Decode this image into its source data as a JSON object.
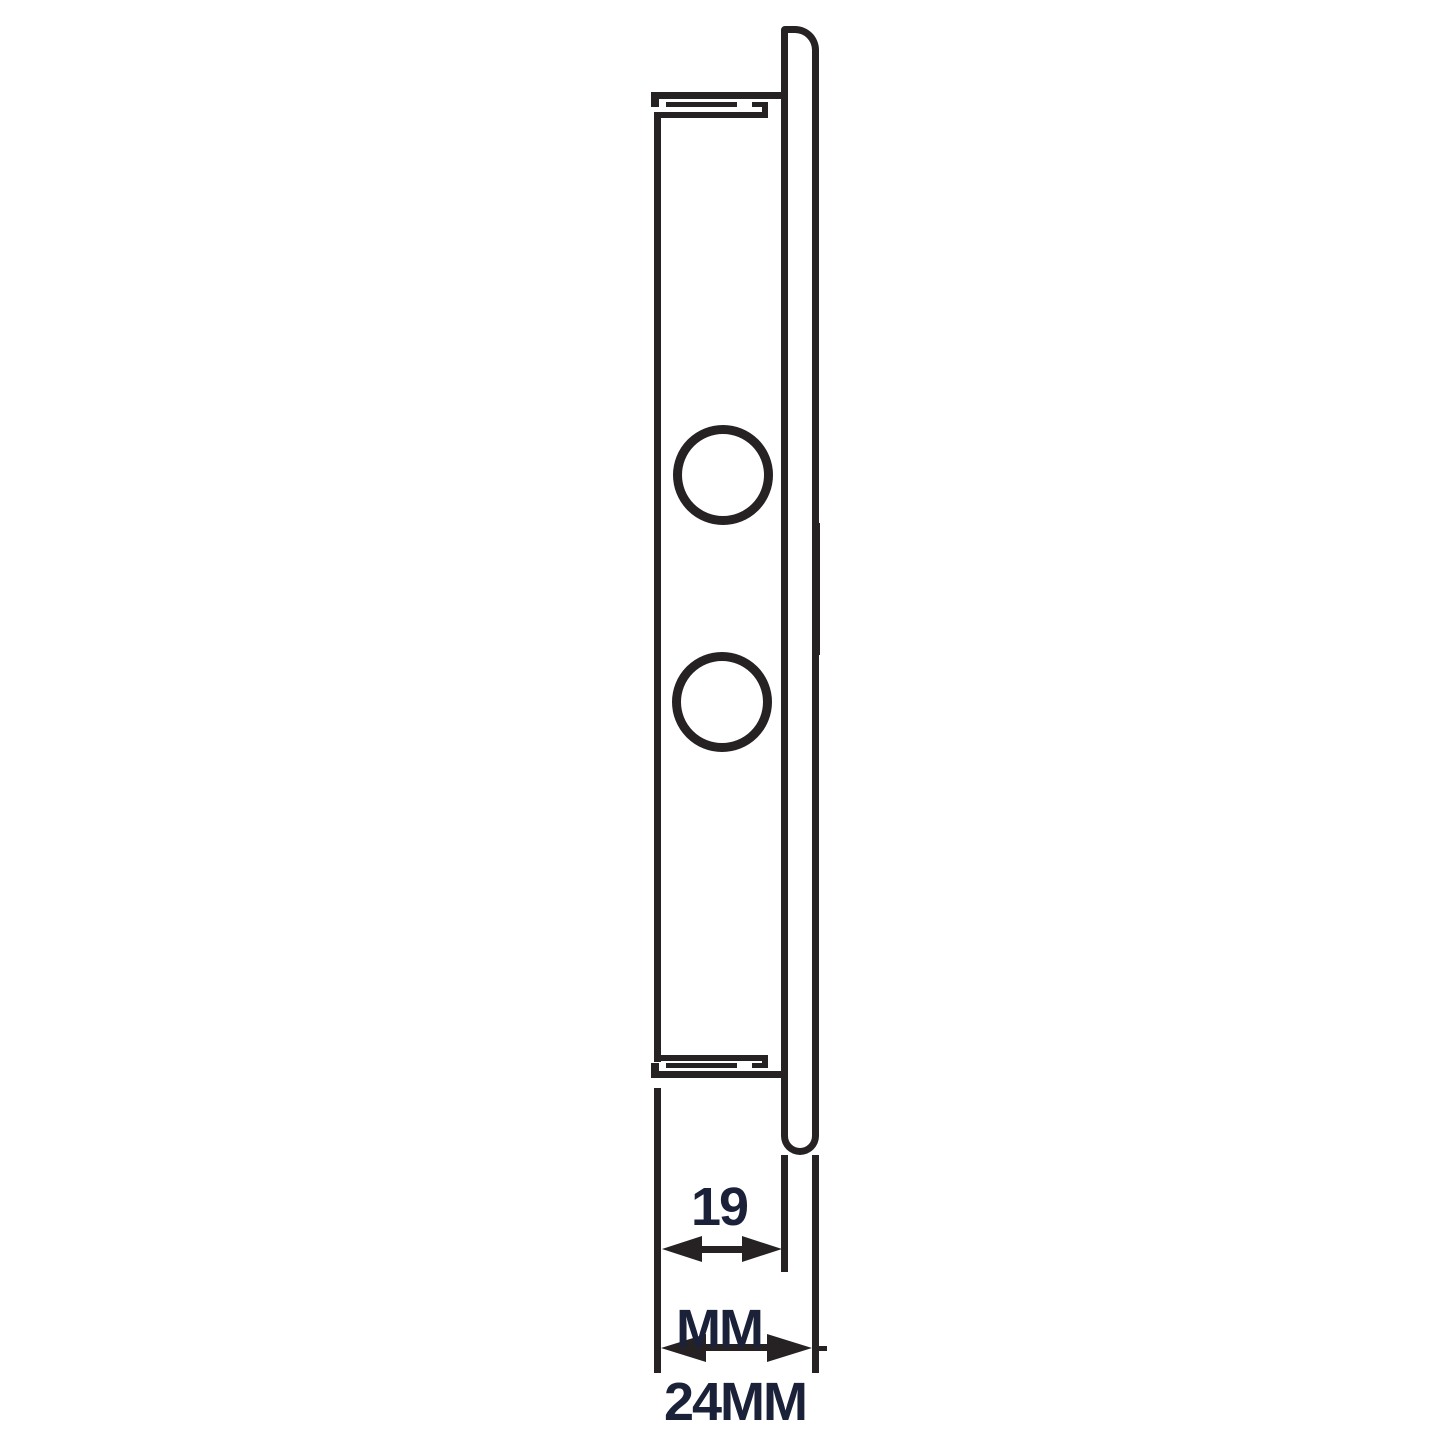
{
  "page": {
    "background": "#ffffff",
    "description": "Side-profile technical line drawing of a wall vent / plate assembly with depth dimensions"
  },
  "colors": {
    "line": "#262223",
    "text": "#1a2138"
  },
  "labels": {
    "dim_19_value": "19",
    "dim_19_unit": "MM",
    "dim_24": "24MM"
  }
}
